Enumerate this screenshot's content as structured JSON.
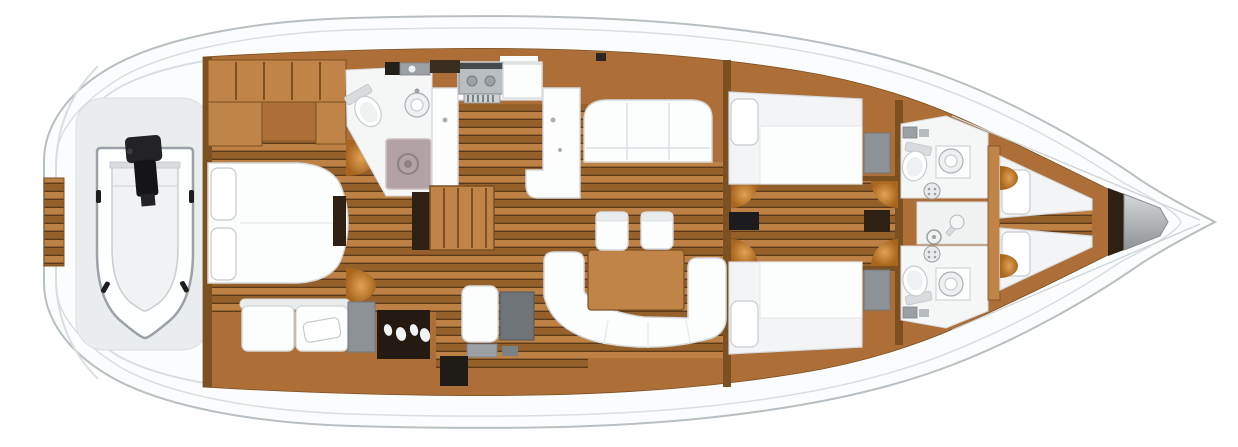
{
  "title": "Sailing yacht interior layout plan, top view, bow to the right",
  "colors": {
    "background": "#ffffff",
    "hull_fill": "#fbfcfd",
    "hull_stroke": "#b8bfc3",
    "deck_line": "#d9dee1",
    "garage_shade": "#eaedee",
    "wood_light": "#c08449",
    "wood_mid": "#ad6f37",
    "wood_dark": "#7c5020",
    "plank_light": "#bd8146",
    "plank_mid": "#a76a31",
    "plank_dark": "#96602a",
    "plank_gap": "#5e3b18",
    "white_furn": "#fcfdfd",
    "furn_stroke": "#d6dadd",
    "furn_shade": "#e9eced",
    "room_white": "#f5f6f6",
    "shower_tray": "#b3a2a4",
    "tray_rim": "#cec0c2",
    "gray_box": "#8d9296",
    "steel_light": "#d5d7d8",
    "steel_dark": "#8f9395",
    "dark_wood": "#2e2013",
    "black": "#1c1c1e",
    "glow_in": "#e0a255",
    "glow_out": "#a8661e"
  },
  "areas": [
    {
      "name": "swim-platform",
      "items": [
        "teak-steps"
      ]
    },
    {
      "name": "tender-garage",
      "items": [
        "inflatable-dinghy",
        "outboard-motor"
      ]
    },
    {
      "name": "owners-cabin-aft",
      "items": [
        "wardrobe-cabinets",
        "island-double-bed",
        "two-pillows",
        "sofa",
        "sofa-pillow",
        "storage-locker",
        "vanity-unit"
      ]
    },
    {
      "name": "aft-head",
      "items": [
        "toilet",
        "washbasin",
        "shower-tray",
        "drain"
      ]
    },
    {
      "name": "galley",
      "items": [
        "cooktop",
        "counter",
        "sink-counter",
        "refrigerator"
      ]
    },
    {
      "name": "companionway",
      "items": [
        "stairs",
        "nav-seat",
        "chart-table"
      ]
    },
    {
      "name": "saloon",
      "items": [
        "port-settee",
        "u-shaped-sofa",
        "dining-table",
        "chair",
        "chair"
      ]
    },
    {
      "name": "corridor",
      "items": [
        "mast-post",
        "light-glows"
      ]
    },
    {
      "name": "guest-cabin-port",
      "items": [
        "double-bed",
        "pillow",
        "locker"
      ]
    },
    {
      "name": "guest-cabin-starboard",
      "items": [
        "double-bed",
        "pillow",
        "locker"
      ]
    },
    {
      "name": "forward-head-port",
      "items": [
        "toilet",
        "washbasin",
        "drain-grate"
      ]
    },
    {
      "name": "forward-head-starboard",
      "items": [
        "toilet",
        "washbasin",
        "drain-grate"
      ]
    },
    {
      "name": "forward-shower",
      "items": [
        "hand-shower",
        "drain"
      ]
    },
    {
      "name": "bow-cabin",
      "items": [
        "v-berth-port",
        "v-berth-starboard",
        "pillows"
      ]
    },
    {
      "name": "anchor-locker",
      "items": []
    }
  ]
}
